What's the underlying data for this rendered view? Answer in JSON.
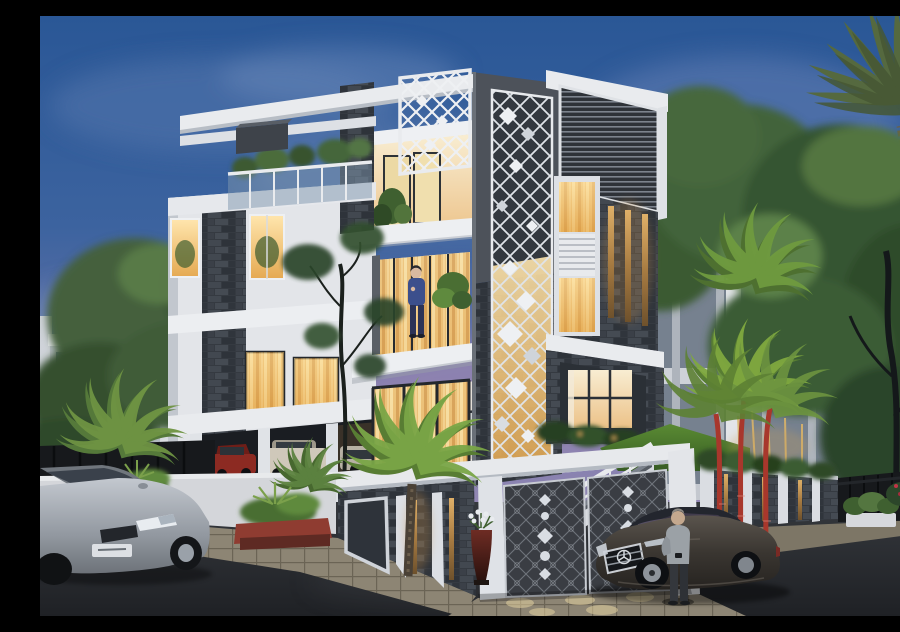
{
  "meta": {
    "description": "Dusk architectural rendering of a four-storey modern villa with charcoal stone and white facade, glowing golden interiors, ornamental gates, palms, and two sedans on the street"
  },
  "palette": {
    "sky_top": "#2a5796",
    "sky_mid": "#6a74a8",
    "sky_horizon": "#b99dbd",
    "cloud_pink": "#b295b9",
    "facade_white": "#e9ebee",
    "facade_shadow": "#c6cad1",
    "charcoal": "#4b5057",
    "stone_dark": "#383d44",
    "window_glow": "#f2c87a",
    "curtain_gold": "#e9b865",
    "door_wood": "#8a5731",
    "foliage_dark": "#2f4a2b",
    "foliage_mid": "#44603c",
    "foliage_bright": "#6f9443",
    "palm_stem_red": "#a8372c",
    "lawn_green": "#55842f",
    "wall_white": "#d4d6da",
    "gate_dark": "#3a3d43",
    "gate_beam_white": "#e7e9ec",
    "fence_black": "#17191c",
    "road_dark": "#26282c",
    "pavement": "#8d8574",
    "car_silver": "#b9bfc7",
    "car_luxury_dark": "#3a3631",
    "person_shirt_gray": "#9ba1a6",
    "person_outfit_blue": "#3c4f8c",
    "amber_light": "#d9a85c"
  },
  "scene": {
    "labels": {
      "sky": "Dusk sky with pink-purple clouds",
      "main_villa": "Four-storey modern villa with lit interiors",
      "tower_jali": "Charcoal tower with white diamond lattice screen",
      "louver_band": "Horizontal louvered panel",
      "roof_pergola": "White rooftop pergola and trellis",
      "roof_terrace": "Roof terrace with glass balustrade and plants",
      "balcony_person": "Person standing on second-floor balcony",
      "entrance_door": "Wooden entrance door with glass railing",
      "carport": "Ground-floor carport with parked cars",
      "gate": "Dark ornamental entrance gates with white motifs",
      "staircase": "Entrance staircase behind gate",
      "left_wall": "White compound wall",
      "right_wall": "Stone pillar wall with lit amber slats and hedge",
      "neighbor_left": "Distant white house at left",
      "neighbor_right": "Glass-framed neighbouring building",
      "sedan_silver": "Silver sedan parked at street left",
      "sedan_luxury": "Dark luxury sedan with chrome grille",
      "street_person": "Man in gray shirt standing beside the car",
      "flower_vase": "Dark vase with white flowers by the gate",
      "driveway": "Paved driveway with pools of light",
      "palms": "Ornamental palms and lipstick palms",
      "lawn": "Front lawn behind the wall",
      "road": "Asphalt street in foreground"
    }
  }
}
